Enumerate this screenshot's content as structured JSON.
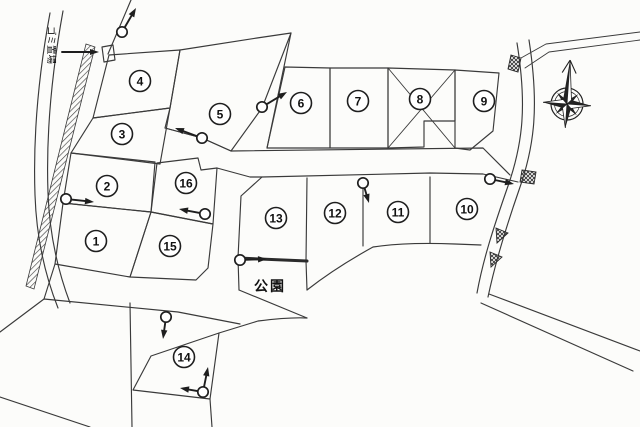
{
  "map": {
    "kind": "land-subdivision-site-plan",
    "colors": {
      "paper": "#fcfcfa",
      "line": "#3a3a3a",
      "ink": "#111111"
    },
    "labels": {
      "garbage": "ゴミ置場",
      "park": "公園"
    },
    "compass": {
      "icon": "compass-rose",
      "direction_up": "N"
    },
    "plots": [
      {
        "n": "1",
        "x": 96,
        "y": 241
      },
      {
        "n": "2",
        "x": 107,
        "y": 186
      },
      {
        "n": "3",
        "x": 122,
        "y": 134
      },
      {
        "n": "4",
        "x": 140,
        "y": 81
      },
      {
        "n": "5",
        "x": 220,
        "y": 114
      },
      {
        "n": "6",
        "x": 301,
        "y": 103
      },
      {
        "n": "7",
        "x": 358,
        "y": 101
      },
      {
        "n": "8",
        "x": 420,
        "y": 99
      },
      {
        "n": "9",
        "x": 484,
        "y": 101
      },
      {
        "n": "10",
        "x": 467,
        "y": 209
      },
      {
        "n": "11",
        "x": 398,
        "y": 212
      },
      {
        "n": "12",
        "x": 335,
        "y": 213
      },
      {
        "n": "13",
        "x": 276,
        "y": 218
      },
      {
        "n": "14",
        "x": 184,
        "y": 357
      },
      {
        "n": "15",
        "x": 170,
        "y": 246
      },
      {
        "n": "16",
        "x": 186,
        "y": 183
      }
    ],
    "crossed_plot": "8",
    "markers": {
      "icon": "survey-marker-arrow",
      "items": [
        {
          "x": 122,
          "y": 32,
          "arrows": [
            [
              136,
              8
            ]
          ]
        },
        {
          "x": 202,
          "y": 138,
          "arrows": [
            [
              175,
              128
            ]
          ]
        },
        {
          "x": 262,
          "y": 107,
          "arrows": [
            [
              287,
              92
            ]
          ]
        },
        {
          "x": 66,
          "y": 199,
          "arrows": [
            [
              94,
              202
            ]
          ]
        },
        {
          "x": 205,
          "y": 214,
          "arrows": [
            [
              179,
              209
            ]
          ]
        },
        {
          "x": 363,
          "y": 183,
          "arrows": [
            [
              369,
              203
            ]
          ]
        },
        {
          "x": 490,
          "y": 179,
          "arrows": [
            [
              514,
              184
            ]
          ]
        },
        {
          "x": 240,
          "y": 260,
          "arrows": [
            [
              267,
              259
            ]
          ]
        },
        {
          "x": 166,
          "y": 317,
          "arrows": [
            [
              163,
              339
            ]
          ]
        },
        {
          "x": 203,
          "y": 392,
          "arrows": [
            [
              208,
              367
            ],
            [
              180,
              388
            ]
          ]
        }
      ]
    }
  }
}
